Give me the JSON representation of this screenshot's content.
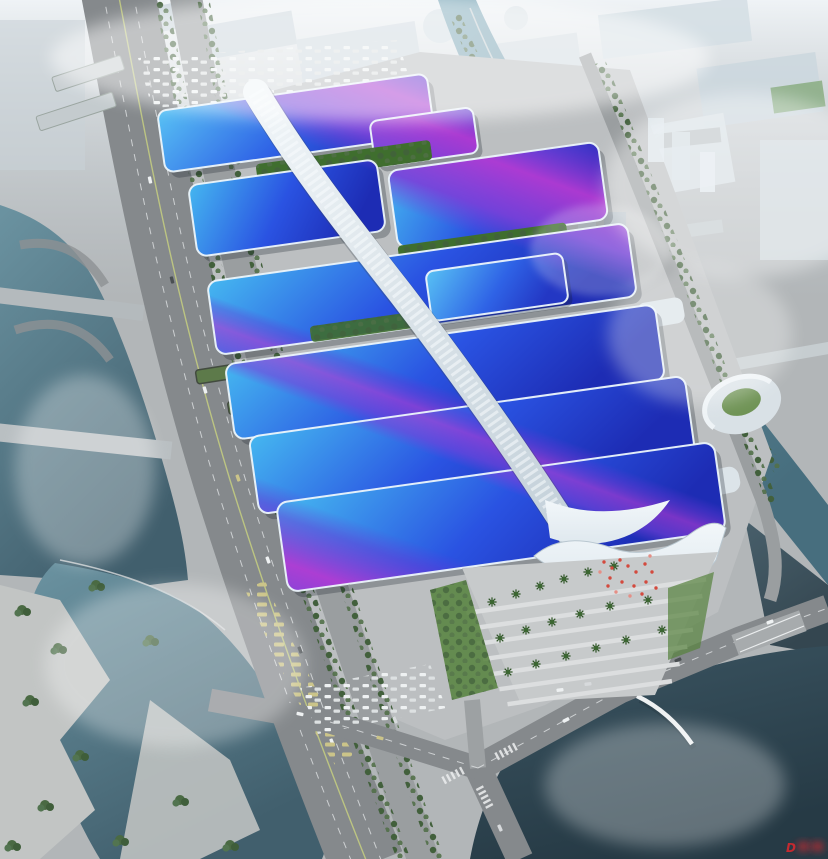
{
  "scene": {
    "subject": "aerial rendering of a large exhibition and convention center campus",
    "regions": {
      "backdrop": "hazy white city skyline",
      "left": "elevated highway, boulevard and river",
      "right": "canal with bridges, towers, spiral building",
      "bottom": "lakes, road intersection, pedestrian arc bridge",
      "center": "exhibition halls with blue wave roofs, purple ribbon graphics, white segmented spine walkway, entrance canopy and palm plaza"
    },
    "hall_rows": 6,
    "crowd": "red visitor specks on entrance plaza"
  },
  "palette": {
    "haze": "#ffffff",
    "sky_top": "#eff3f6",
    "city_block": "#c6d1d9",
    "ground": "#b2b6b8",
    "apron": "#bcbfc1",
    "road": "#85898c",
    "road_light": "#9a9ea0",
    "plaza": "#c7cacb",
    "plaza_stripe": "#dcdedf",
    "water_light": "#82acbc",
    "water_dark": "#476e7e",
    "lakebl_light": "#6b93a1",
    "lakebl_dark": "#415f6d",
    "lakebr_light": "#3c5663",
    "lakebr_dark": "#263a45",
    "tree": "#42603c",
    "tree_light": "#527049",
    "lawn": "#55813c",
    "courtyard": "#3f6e2e",
    "roof_light": "#45b7f0",
    "roof_mid": "#2a53e2",
    "roof_deep": "#1d2cb4",
    "ribbon_purple": "#7b40d9",
    "ribbon_magenta": "#b23ad2",
    "spine_light": "#f0f5f8",
    "spine_shade": "#c3d0d9",
    "canopy": "#dfe8ee",
    "crowd": "#d34a3e",
    "watermark": "#c42a30",
    "car": "#eef1f2",
    "bus": "#cbc489"
  },
  "watermark": {
    "glyph": "D",
    "note": "small red logo watermark, characters illegible"
  }
}
